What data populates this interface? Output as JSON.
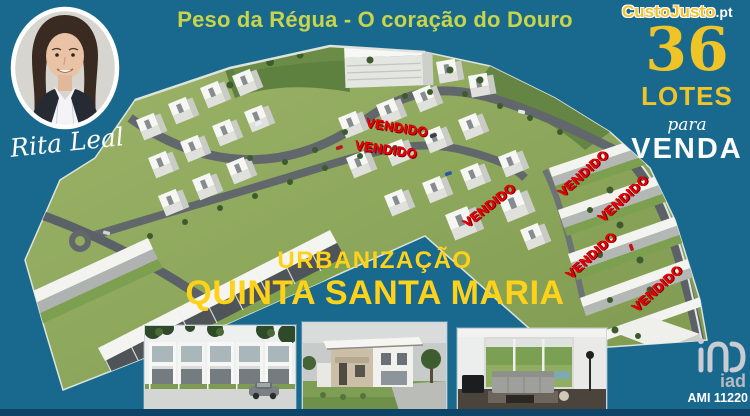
{
  "header": {
    "title": "Peso da Régua - O coração do Douro"
  },
  "agent": {
    "signature": "Rita Leal"
  },
  "marketplace": {
    "name": "CustoJusto",
    "tld": ".pt"
  },
  "offer": {
    "count": "36",
    "unit": "LOTES",
    "preposition": "para",
    "action": "VENDA"
  },
  "project": {
    "kicker": "URBANIZAÇÃO",
    "name": "QUINTA SANTA MARIA"
  },
  "sold": {
    "label": "VENDIDO",
    "items": [
      "VENDIDO",
      "VENDIDO",
      "VENDIDO",
      "VENDIDO",
      "VENDIDO",
      "VENDIDO",
      "VENDIDO"
    ]
  },
  "agency": {
    "brand": "iad",
    "license": "AMI 11220"
  },
  "colors": {
    "background": "#19698f",
    "accent_yellow": "#ffd21a",
    "gold": "#eec427",
    "title_yellow_green": "#c8d549",
    "sold_red": "#ee0005",
    "white": "#ffffff",
    "bottom_strip": "#0e4368"
  }
}
